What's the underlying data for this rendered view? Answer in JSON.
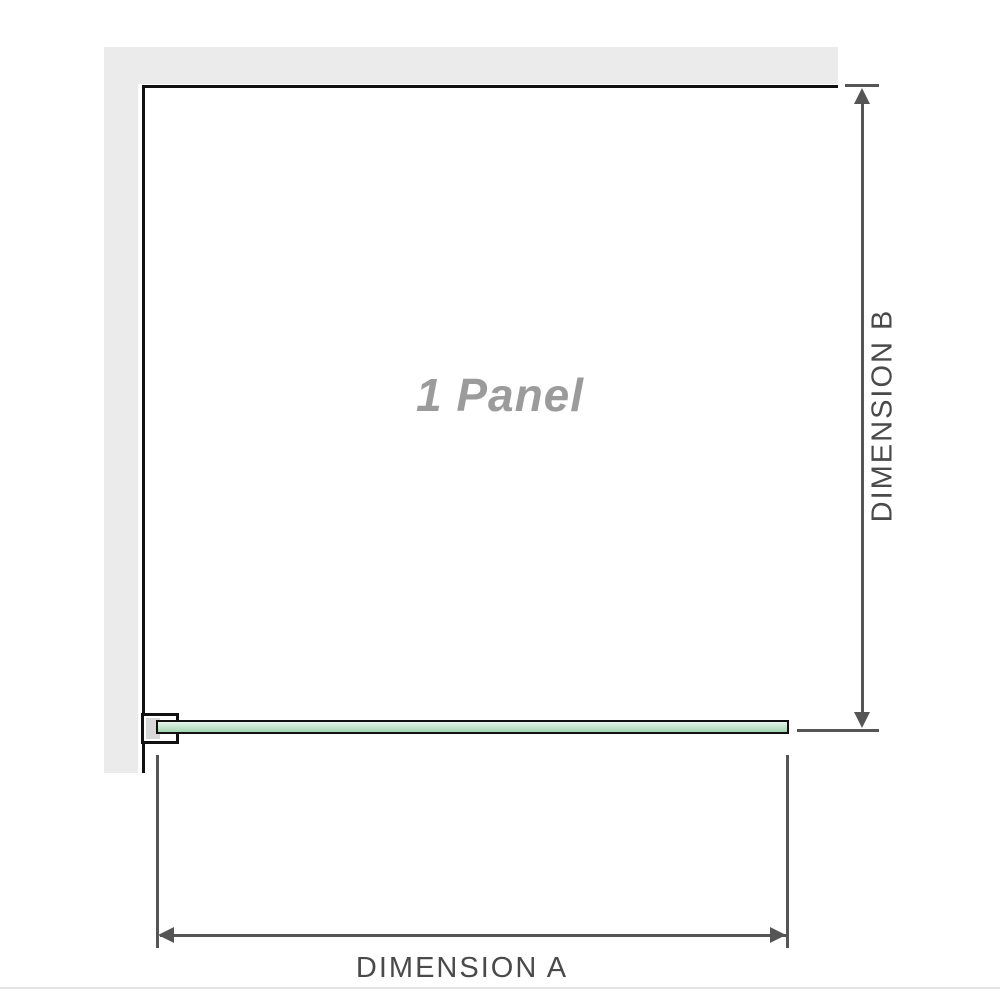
{
  "diagram": {
    "panel_label": "1 Panel",
    "dimension_a": {
      "label": "DIMENSION A"
    },
    "dimension_b": {
      "label": "DIMENSION B"
    }
  },
  "colors": {
    "wall_gray": "#ebebeb",
    "bracket_gray": "#d8d8d8",
    "panel_border": "#111111",
    "dimension_line": "#555555",
    "label_text": "#4a4a4a",
    "watermark_text": "#9b9b9b",
    "glass_green_top": "#e6f5ea",
    "glass_green_bottom": "#a3d6b1"
  }
}
